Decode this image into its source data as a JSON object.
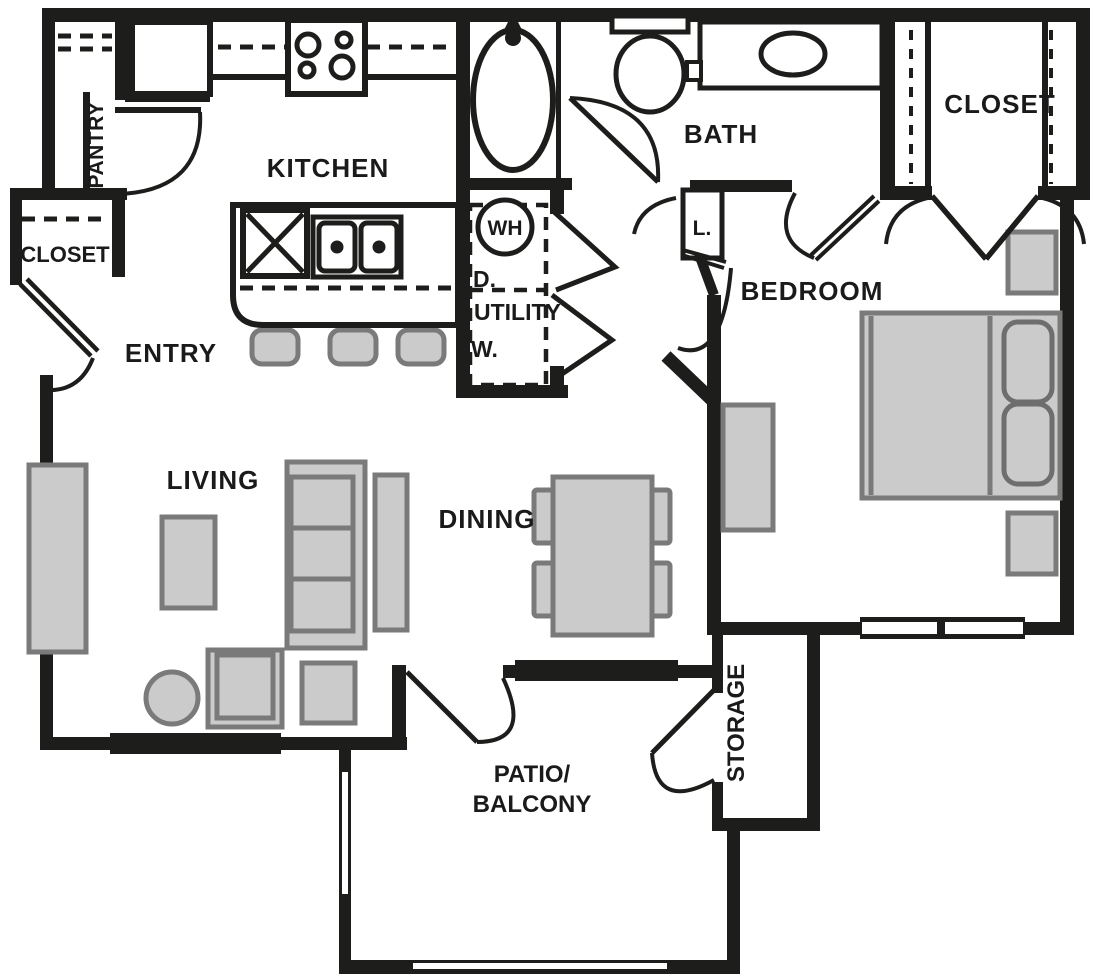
{
  "title": "One-bedroom apartment floor plan",
  "colors": {
    "background": "#ffffff",
    "wall": "#1d1d1b",
    "text": "#1a1a1a",
    "furniture_fill": "#cbcbcb",
    "furniture_stroke": "#7a7a7a"
  },
  "labels": {
    "kitchen": "KITCHEN",
    "pantry": "PANTRY",
    "entry_closet": "CLOSET",
    "entry": "ENTRY",
    "bath": "BATH",
    "bedroom_closet": "CLOSET",
    "bedroom": "BEDROOM",
    "living": "LIVING",
    "dining": "DINING",
    "utility": "UTILITY",
    "storage": "STORAGE",
    "patio_line1": "PATIO/",
    "patio_line2": "BALCONY",
    "water_heater": "WH",
    "dryer": "D.",
    "washer": "W.",
    "linen": "L."
  }
}
